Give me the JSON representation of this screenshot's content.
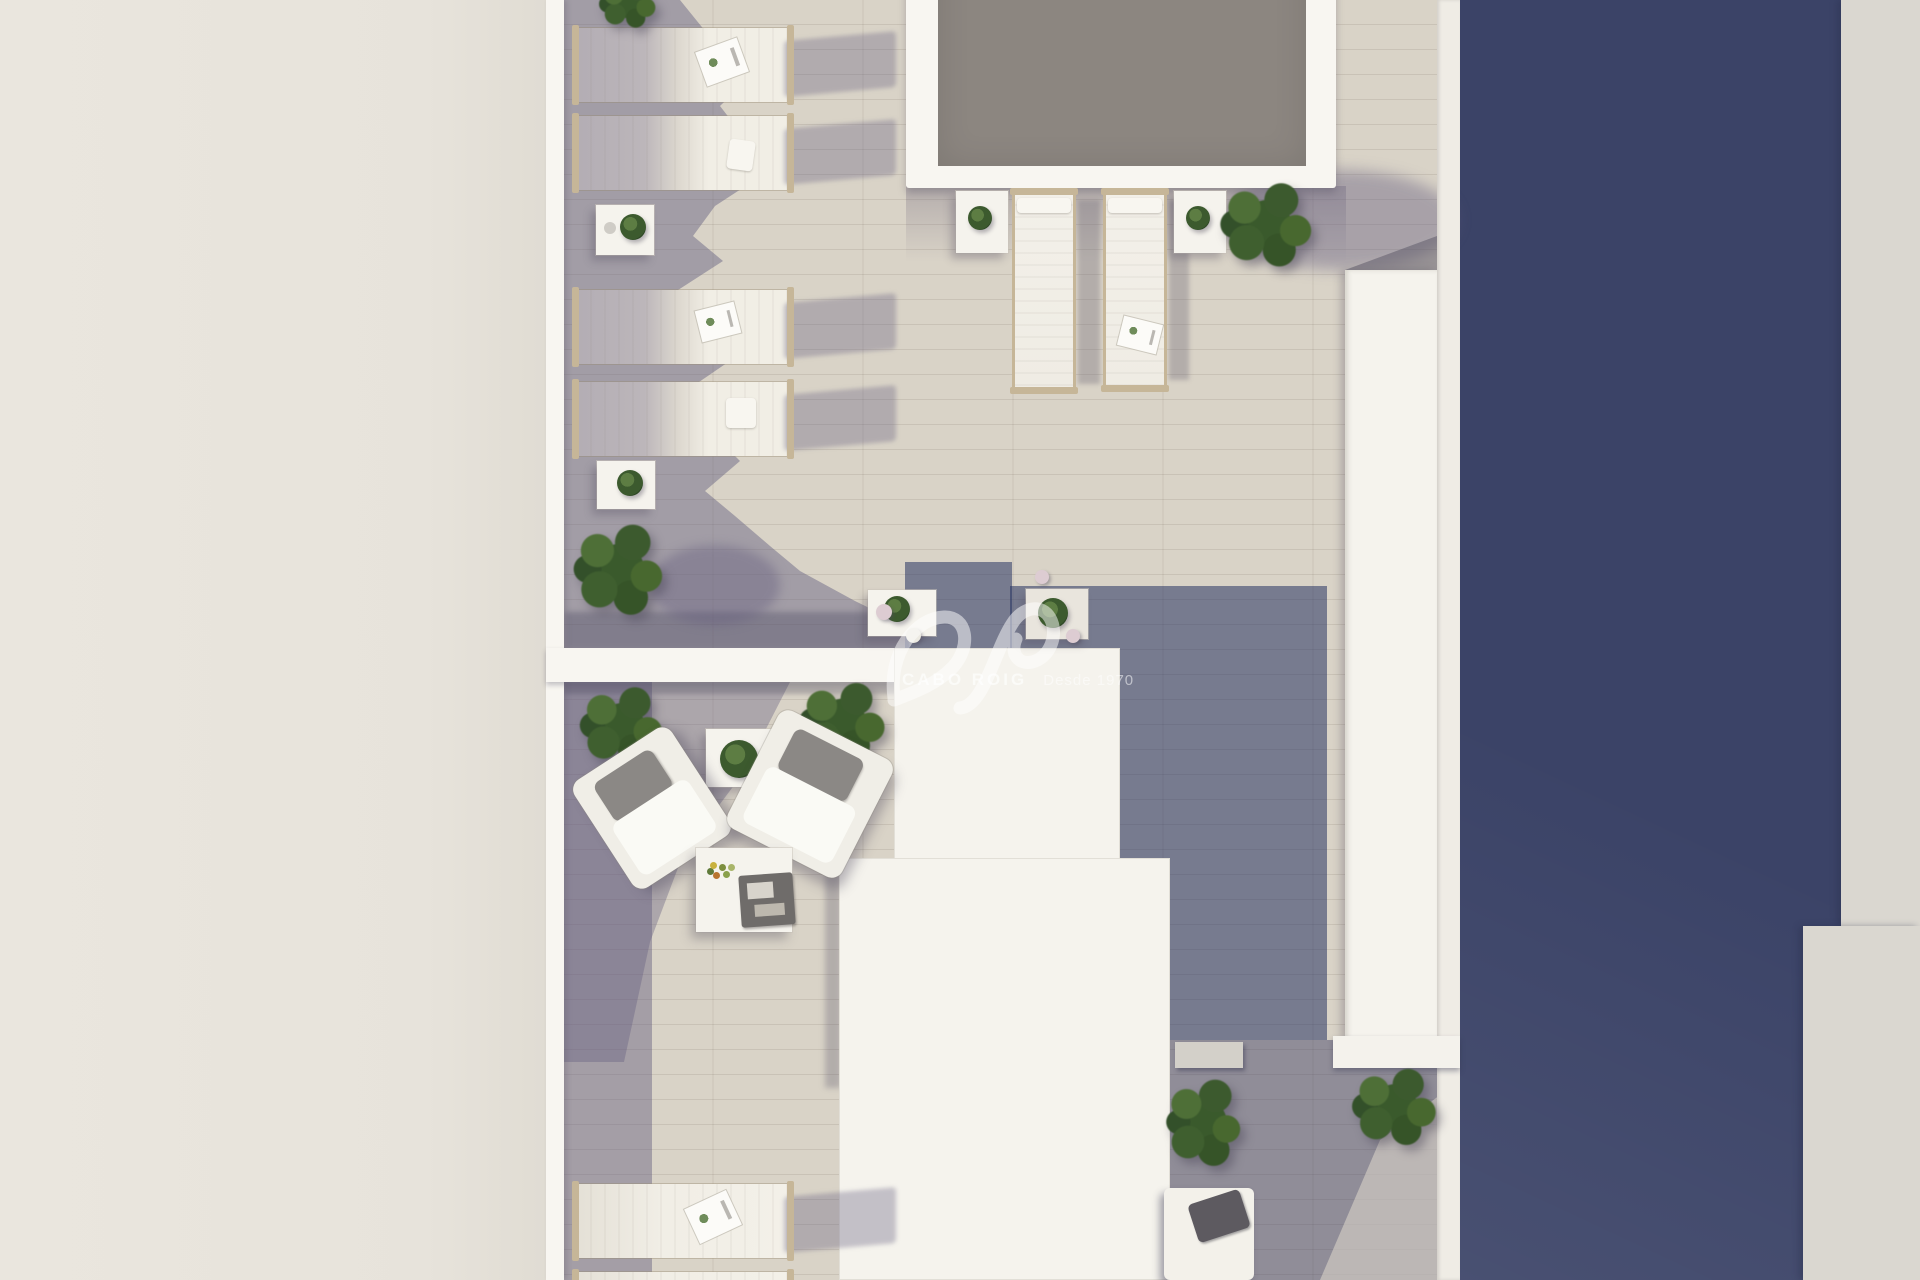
{
  "scene": {
    "type": "architectural-3d-render",
    "view": "top-down aerial",
    "subject": "Rooftop terrace with swimming pool, sun loungers, bistro tables and lounge seating between light and dark buildings"
  },
  "watermark": {
    "logo": "av-monogram",
    "brand": "CABO ROIG",
    "tagline": "Desde 1970"
  },
  "palette": {
    "neighbor-roof": "#eae6de",
    "parapet": "#f8f6f1",
    "floor-lit": "#d9d3c7",
    "floor-shadow": "#a49ea6",
    "floor-deep-shadow": "#6e7389",
    "pool-water": "#8c8680",
    "building-navy": "#3b4367",
    "right-wall": "#dad7d0",
    "structure-white": "#f5f3ed",
    "frame-tan": "#c6b698",
    "cushion-gray": "#8b8885",
    "pillow-dark": "#5d5a60",
    "foliage-dark": "#2f4926",
    "foliage-mid": "#3c5a2e",
    "foliage-light": "#5d7d43"
  },
  "objects": {
    "swimming_pool": 1,
    "sun_loungers": 8,
    "armchairs": 2,
    "bistro_sets": 2,
    "side_tables": 5,
    "coffee_table": 1,
    "daybed": 1,
    "bench": 1,
    "bushes": 7,
    "potted_plants": 7
  }
}
